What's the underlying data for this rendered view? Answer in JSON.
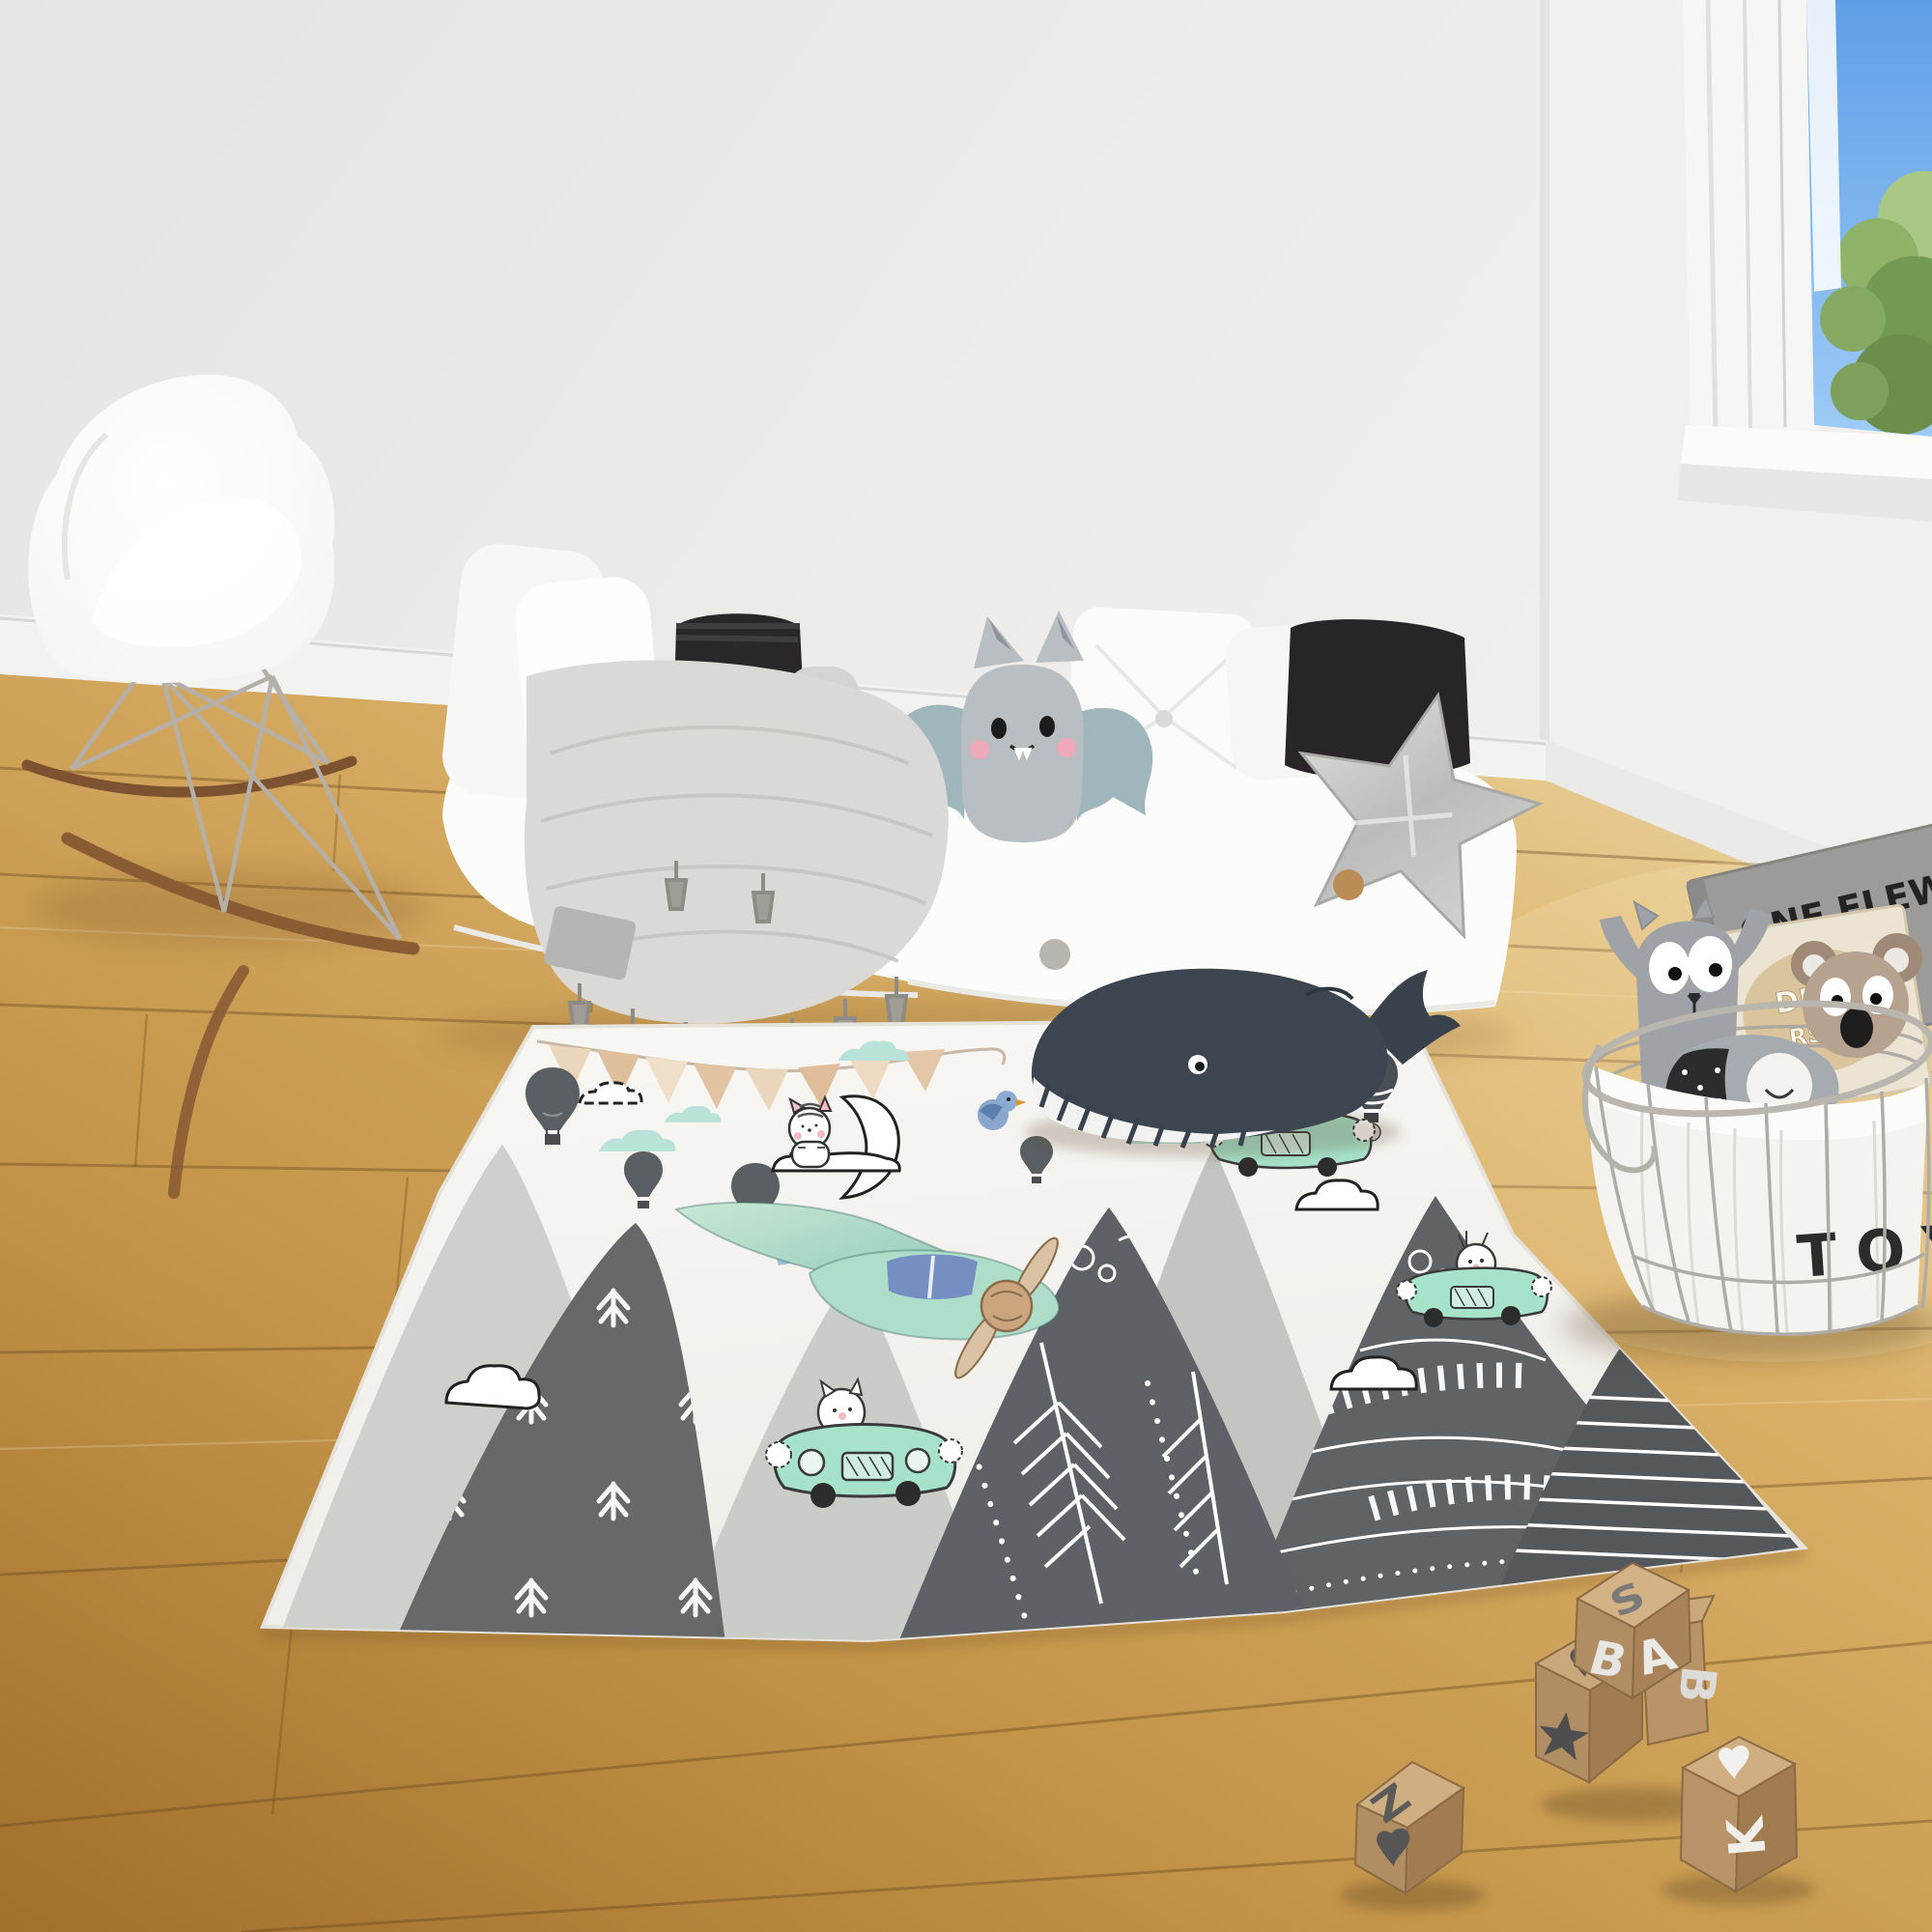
{
  "basket": {
    "label": "TOY"
  },
  "books": {
    "gray": {
      "line1": "ONE FLEW",
      "line2": "THE"
    },
    "beige": {
      "line1": "DRED",
      "line2": "RS OF"
    }
  },
  "blocks": {
    "stack_top": "S",
    "stack_front_left": "B",
    "stack_front_right": "A",
    "floor_block_top": "Z",
    "leaning_block_side": "B",
    "heart_block_front": "K"
  },
  "colors": {
    "wall": "#eceae8",
    "floor_light": "#e3c285",
    "floor_dark": "#a8782f",
    "rug_base": "#f7f6f3",
    "mountain_dark": "#63666a",
    "mountain_light": "#cbcec9",
    "mint_car": "#a7e3cb",
    "sky": "#6aa7e8",
    "flag_tan": "#e7cdae",
    "whale": "#3d4650"
  }
}
